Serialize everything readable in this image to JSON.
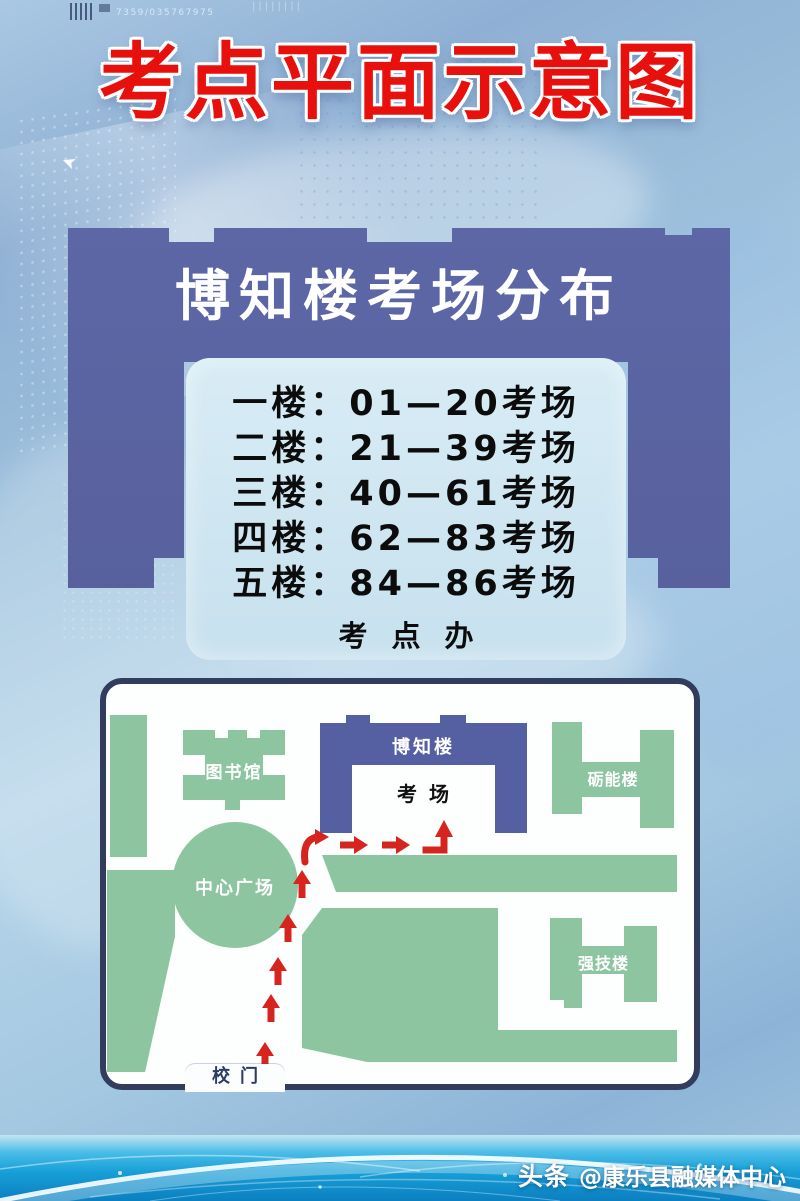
{
  "poster": {
    "title": "考点平面示意图"
  },
  "banner": {
    "title": "博知楼考场分布",
    "floors": [
      "一楼：01—20考场",
      "二楼：21—39考场",
      "三楼：40—61考场",
      "四楼：62—83考场",
      "五楼：84—86考场"
    ],
    "office": "考点办"
  },
  "map": {
    "buildings": {
      "library": "图书馆",
      "bozhi": "博知楼",
      "exam_room": "考场",
      "lineng": "砺能楼",
      "plaza": "中心广场",
      "qiangji": "强技楼",
      "gate": "校门"
    }
  },
  "footer": {
    "platform": "头条",
    "account": "@康乐县融媒体中心"
  },
  "decor": {
    "serial": "7359/035767975",
    "ticks": "||||||||"
  },
  "colors": {
    "title_red": "#e8100c",
    "banner_blue": "#5a64a2",
    "building_blue": "#5560a2",
    "building_green": "#8cc5a0",
    "arrow_red": "#d6251f",
    "panel_light": "#d2e7f2",
    "map_border": "#323c5c",
    "band_cyan": "#18a0d8"
  }
}
